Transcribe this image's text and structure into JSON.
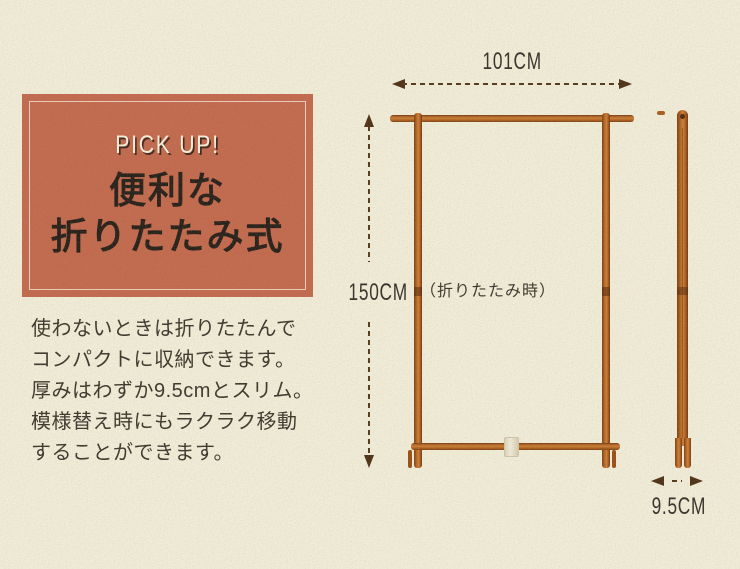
{
  "colors": {
    "background": "#f1edd8",
    "accent_box": "#c2684c",
    "box_border": "#f0e6cf",
    "tagline_text": "#f6f0db",
    "heading_text": "#261f18",
    "body_text": "#3b362c",
    "dimension_text": "#33302a",
    "arrow": "#54381a",
    "wood_light": "#c97e36",
    "wood_dark": "#7c3c10",
    "clip": "#ece5d0"
  },
  "pickup_box": {
    "tagline": "PICK UP!",
    "title_line1": "便利な",
    "title_line2": "折りたたみ式"
  },
  "description": {
    "lines": [
      "使わないときは折りたたんで",
      "コンパクトに収納できます。",
      "厚みはわずか9.5cmとスリム。",
      "模様替え時にもラクラク移動",
      "することができます。"
    ]
  },
  "diagram": {
    "width_label": "101CM",
    "height_label": "150CM",
    "depth_label": "9.5CM",
    "state_label": "（折りたたみ時）"
  }
}
